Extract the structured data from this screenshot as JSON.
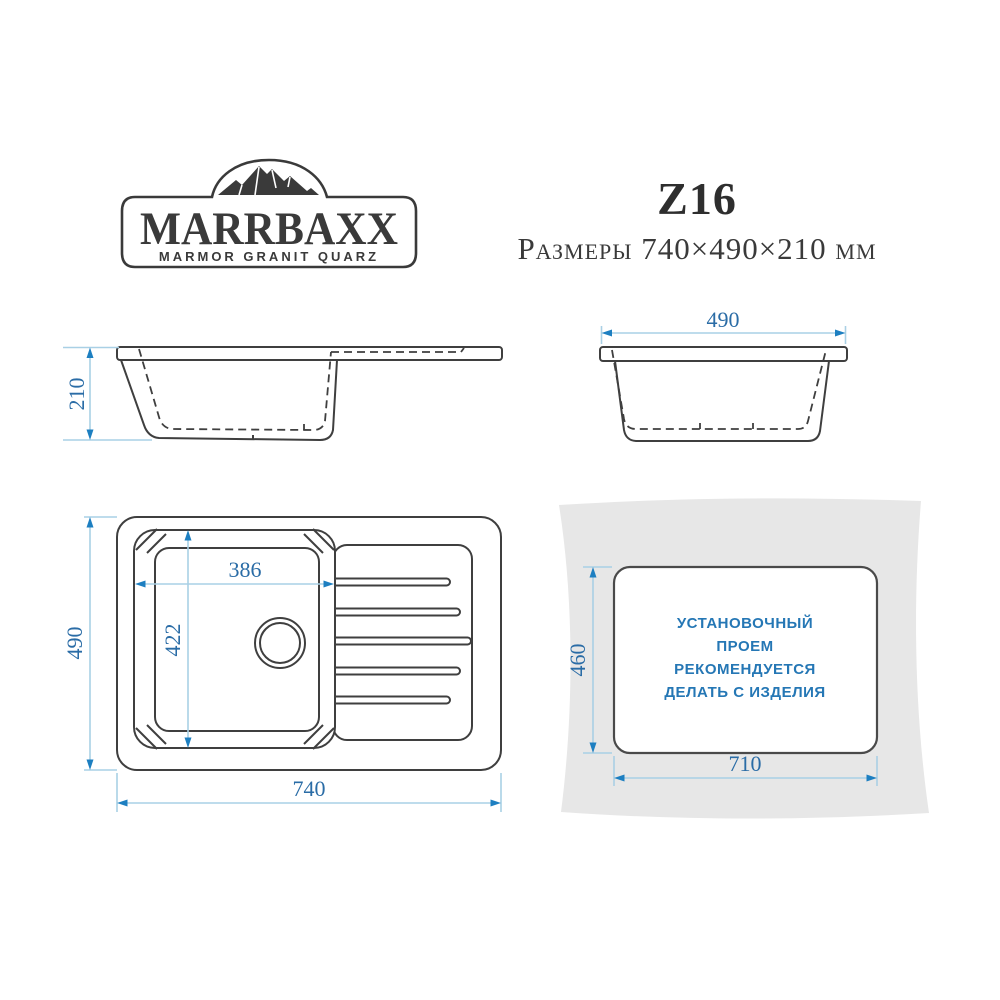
{
  "brand": {
    "name": "MARRBAXX",
    "tagline": "MARMOR GRANIT QUARZ"
  },
  "header": {
    "model": "Z16",
    "size_line": "Размеры 740×490×210 мм"
  },
  "dims": {
    "side_height": "210",
    "front_width": "490",
    "top_bowl_width": "386",
    "top_bowl_depth": "422",
    "top_overall_depth": "490",
    "top_overall_width": "740",
    "cutout_height": "460",
    "cutout_width": "710"
  },
  "cutout_note": {
    "line1": "УСТАНОВОЧНЫЙ",
    "line2": "ПРОЕМ",
    "line3": "РЕКОМЕНДУЕТСЯ",
    "line4": "ДЕЛАТЬ С ИЗДЕЛИЯ"
  },
  "colors": {
    "drawing_line": "#3f3f3f",
    "dimension_line": "#a9d0e5",
    "dimension_arrow": "#1d7fc1",
    "dimension_text": "#2a6ca6",
    "note_text": "#2577b5",
    "countertop_fill": "#e7e7e7"
  }
}
